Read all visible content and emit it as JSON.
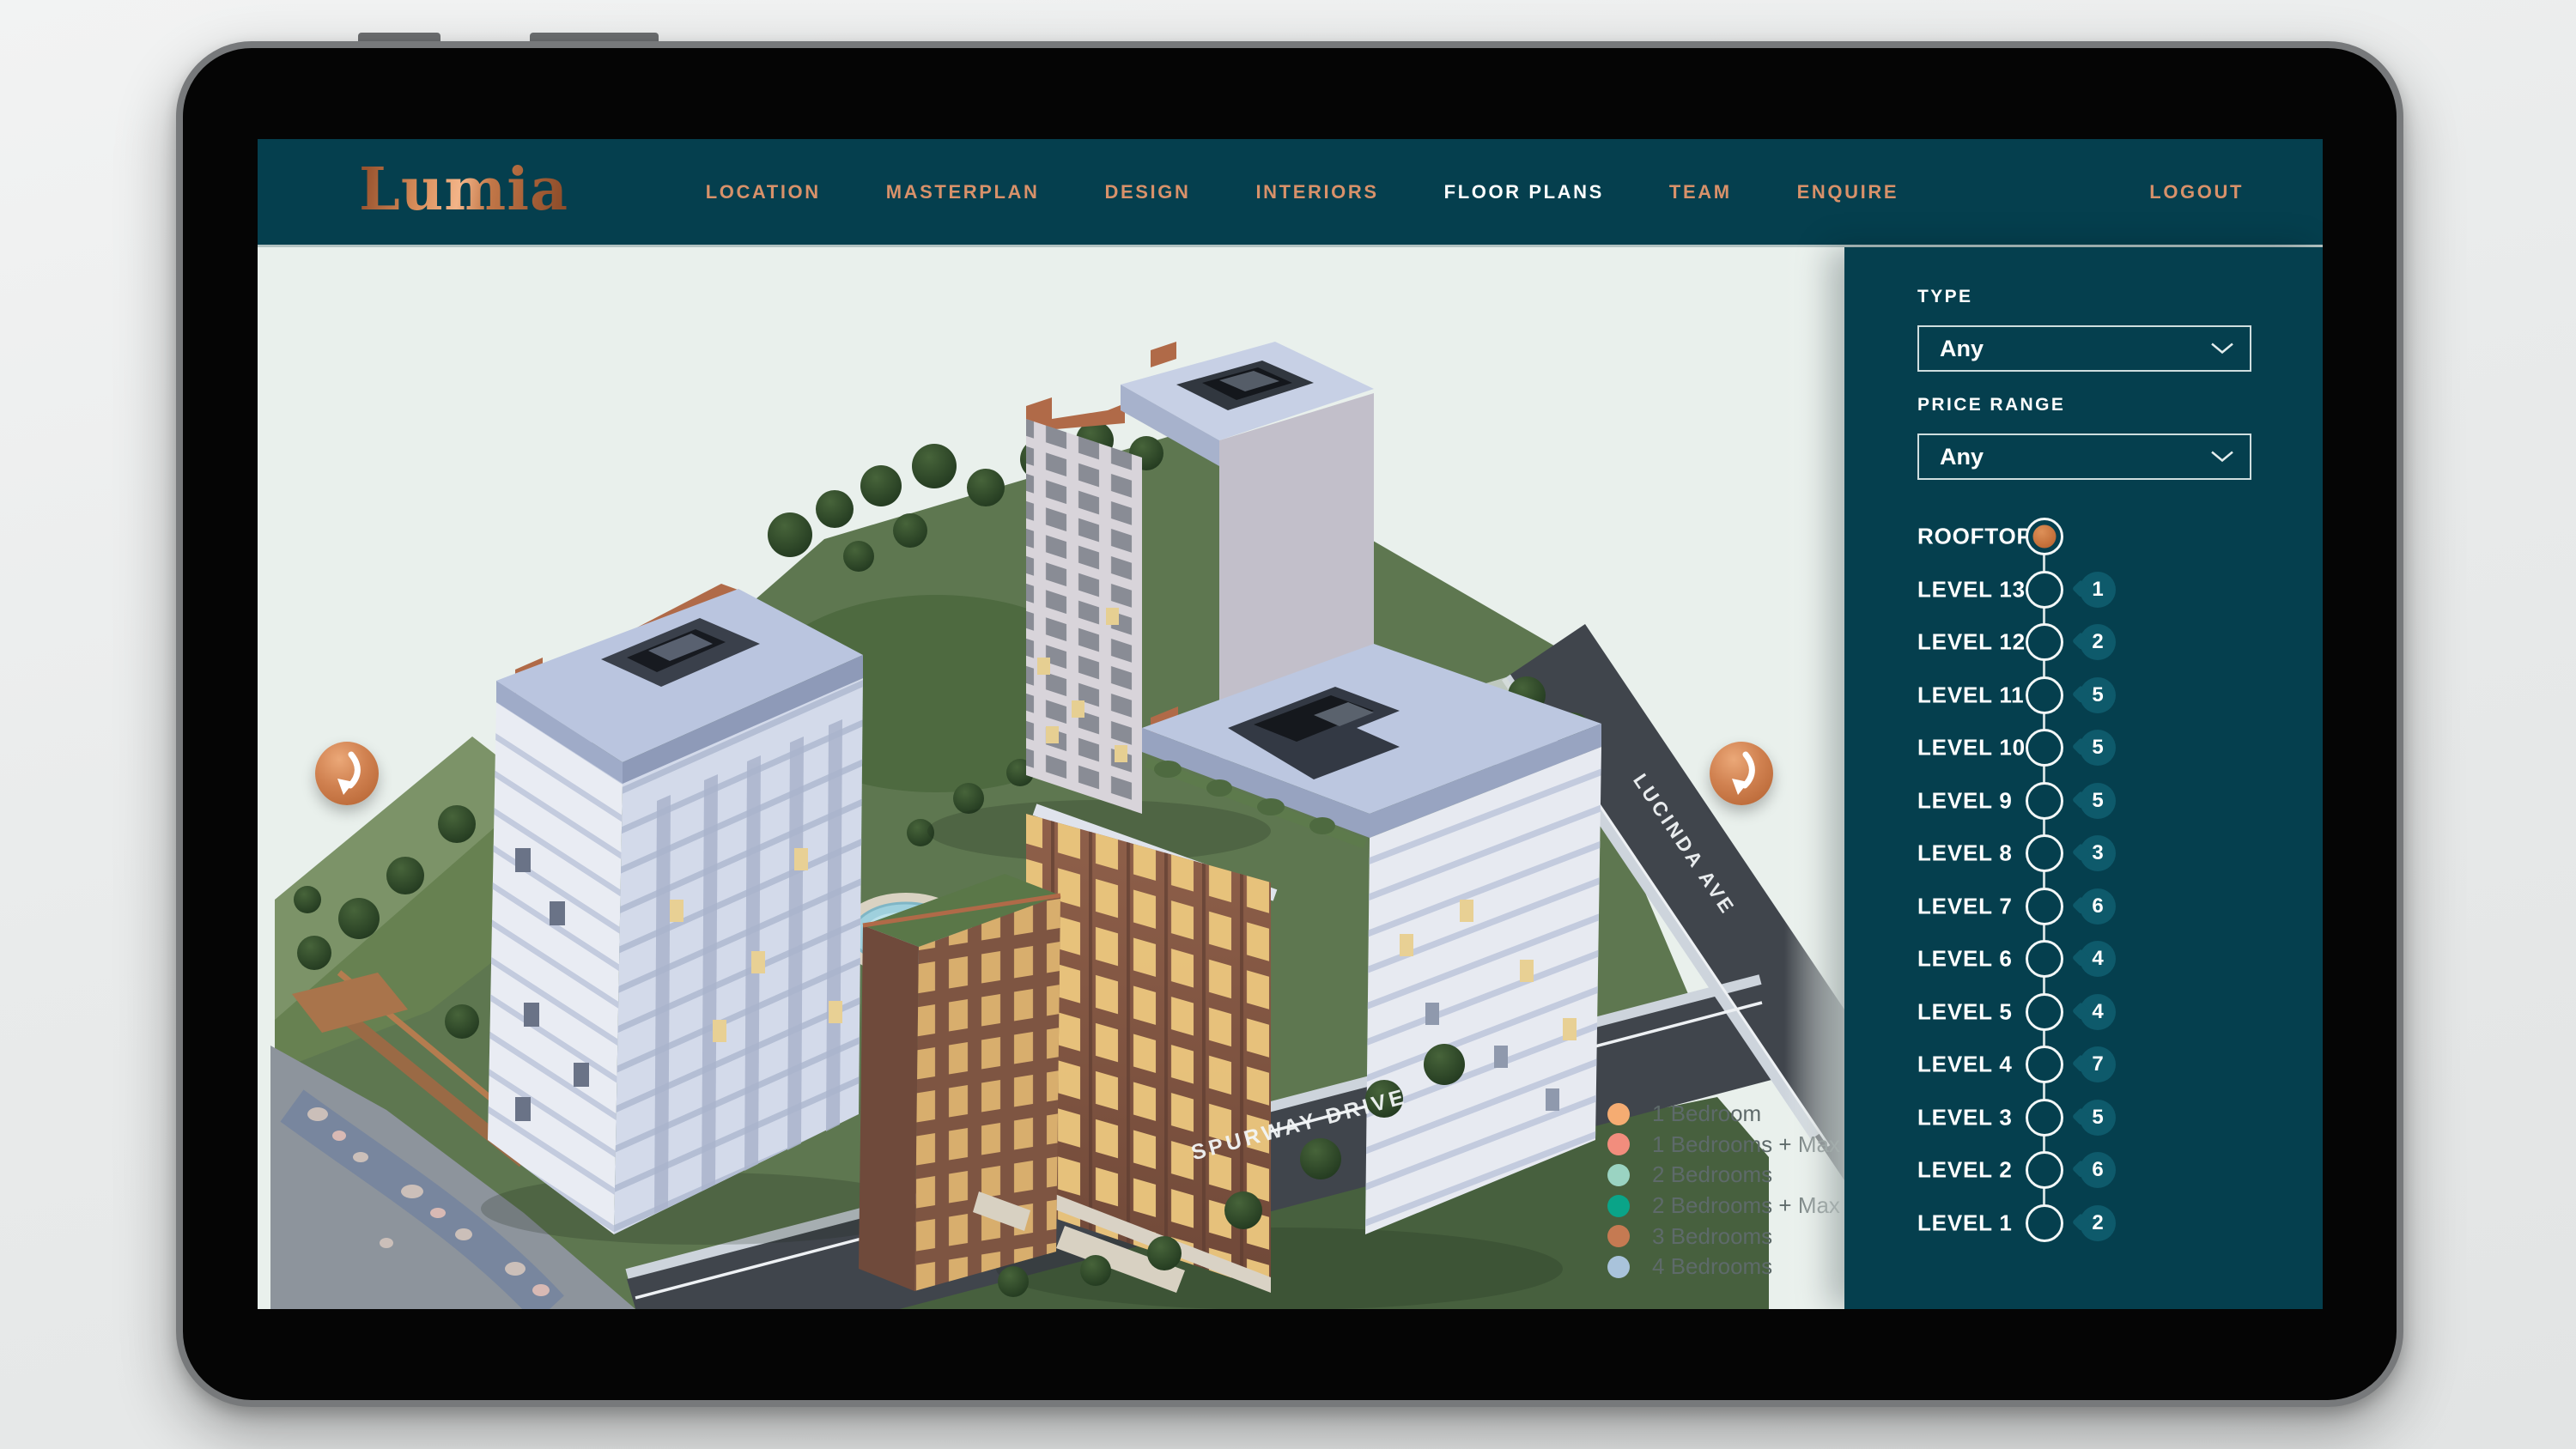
{
  "brand": {
    "logo": "Lumia"
  },
  "navbar": {
    "items": [
      {
        "label": "LOCATION"
      },
      {
        "label": "MASTERPLAN"
      },
      {
        "label": "DESIGN"
      },
      {
        "label": "INTERIORS"
      },
      {
        "label": "FLOOR PLANS"
      },
      {
        "label": "TEAM"
      },
      {
        "label": "ENQUIRE"
      }
    ],
    "active_item": "FLOOR PLANS",
    "logout": "LOGOUT"
  },
  "filters": {
    "type": {
      "label": "TYPE",
      "value": "Any"
    },
    "price_range": {
      "label": "PRICE RANGE",
      "value": "Any"
    }
  },
  "levels": [
    {
      "label": "ROOFTOP",
      "count": "",
      "selected": true
    },
    {
      "label": "LEVEL 13",
      "count": "1",
      "selected": false
    },
    {
      "label": "LEVEL 12",
      "count": "2",
      "selected": false
    },
    {
      "label": "LEVEL 11",
      "count": "5",
      "selected": false
    },
    {
      "label": "LEVEL 10",
      "count": "5",
      "selected": false
    },
    {
      "label": "LEVEL 9",
      "count": "5",
      "selected": false
    },
    {
      "label": "LEVEL 8",
      "count": "3",
      "selected": false
    },
    {
      "label": "LEVEL 7",
      "count": "6",
      "selected": false
    },
    {
      "label": "LEVEL 6",
      "count": "4",
      "selected": false
    },
    {
      "label": "LEVEL 5",
      "count": "4",
      "selected": false
    },
    {
      "label": "LEVEL 4",
      "count": "7",
      "selected": false
    },
    {
      "label": "LEVEL 3",
      "count": "5",
      "selected": false
    },
    {
      "label": "LEVEL 2",
      "count": "6",
      "selected": false
    },
    {
      "label": "LEVEL 1",
      "count": "2",
      "selected": false
    }
  ],
  "scene": {
    "streets": {
      "right": "LUCINDA AVE",
      "bottom": "SPURWAY DRIVE"
    },
    "legend": [
      {
        "label": "1 Bedroom",
        "color": "#F5AC72"
      },
      {
        "label": "1 Bedrooms + Max",
        "color": "#F28D7D"
      },
      {
        "label": "2 Bedrooms",
        "color": "#9AD3C2"
      },
      {
        "label": "2 Bedrooms + Max",
        "color": "#0AA488"
      },
      {
        "label": "3 Bedrooms",
        "color": "#C57A52"
      },
      {
        "label": "4 Bedrooms",
        "color": "#A9C3DB"
      }
    ]
  },
  "theme": {
    "teal": "#053F4E",
    "copper": "#C8794A",
    "copper_text": "#D8916A",
    "active_nav": "#FFFFFF",
    "badge": "#0E5A6B",
    "canvas_bg": "#E9F0EC"
  }
}
